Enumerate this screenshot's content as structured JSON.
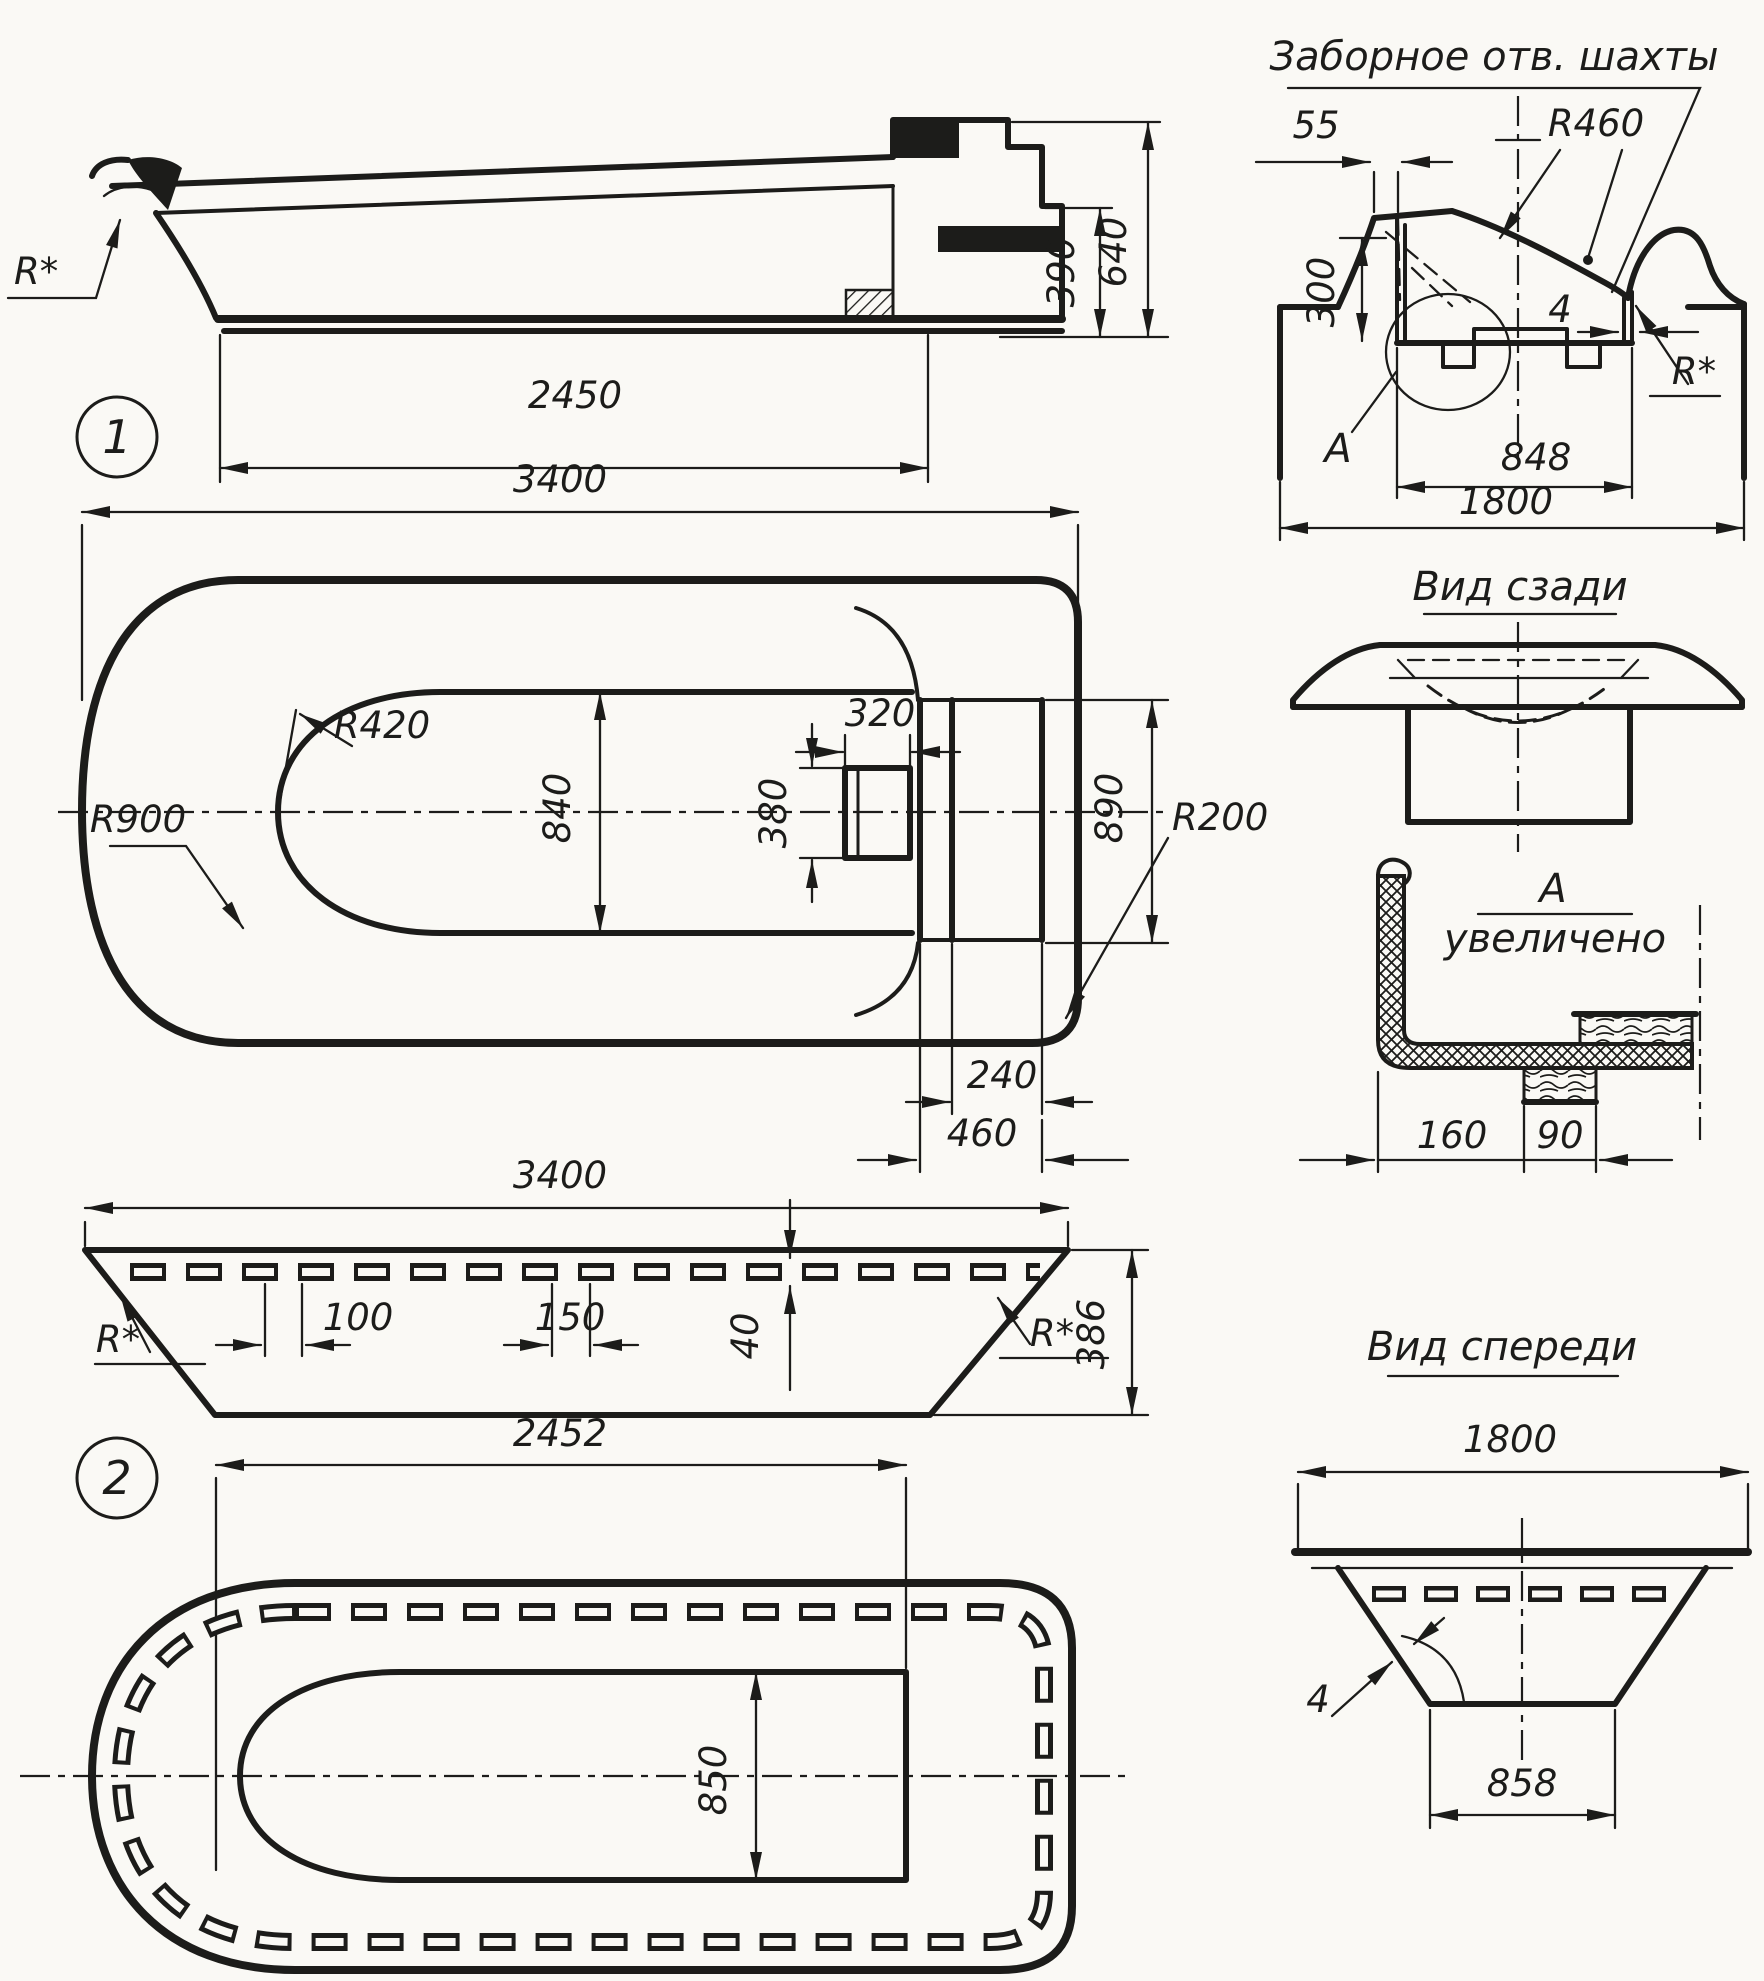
{
  "drawing": {
    "views": {
      "side1": {
        "number": "1",
        "dim_2450": "2450",
        "dim_390": "390",
        "dim_640": "640",
        "radius": "R*"
      },
      "plan1": {
        "dim_3400": "3400",
        "r420": "R420",
        "r900": "R900",
        "dim_840": "840",
        "dim_320": "320",
        "dim_380": "380",
        "dim_890": "890",
        "r200": "R200",
        "dim_240": "240",
        "dim_460": "460"
      },
      "intake": {
        "title": "Заборное отв. шахты",
        "dim_55": "55",
        "r460": "R460",
        "dim_300": "300",
        "dim_4": "4",
        "radius": "R*",
        "detail_ref": "А",
        "dim_848": "848",
        "dim_1800": "1800"
      },
      "rear": {
        "title": "Вид сзади"
      },
      "detail_a": {
        "label": "А",
        "sub": "увеличено",
        "dim_160": "160",
        "dim_90": "90"
      },
      "side2": {
        "number": "2",
        "dim_3400": "3400",
        "dim_100": "100",
        "dim_150": "150",
        "dim_40": "40",
        "dim_386": "386",
        "radius_left": "R*",
        "radius_right": "R*"
      },
      "plan2": {
        "dim_2452": "2452",
        "dim_850": "850"
      },
      "front": {
        "title": "Вид спереди",
        "dim_1800": "1800",
        "dim_4": "4",
        "dim_858": "858"
      }
    }
  }
}
